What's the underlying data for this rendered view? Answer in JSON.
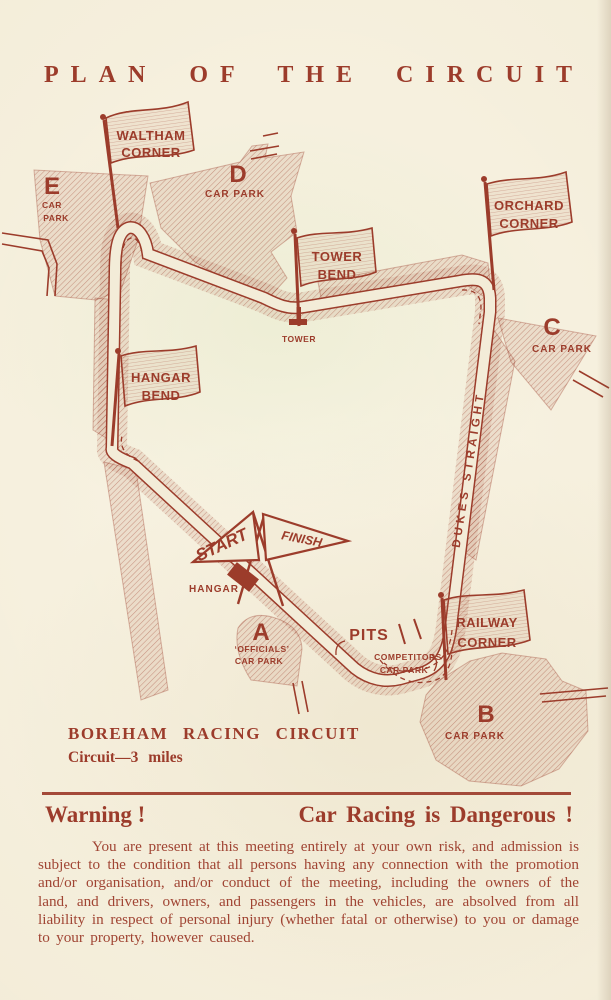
{
  "colors": {
    "ink": "#9c3c2b",
    "paper": "#f3ecd8",
    "hatch": "#b06a52"
  },
  "title": "PLAN OF THE CIRCUIT",
  "map": {
    "flags": {
      "waltham": {
        "line1": "WALTHAM",
        "line2": "CORNER"
      },
      "tower": {
        "line1": "TOWER",
        "line2": "BEND"
      },
      "orchard": {
        "line1": "ORCHARD",
        "line2": "CORNER"
      },
      "hangar": {
        "line1": "HANGAR",
        "line2": "BEND"
      },
      "railway": {
        "line1": "RAILWAY",
        "line2": "CORNER"
      }
    },
    "car_parks": {
      "e": {
        "letter": "E",
        "line1": "CAR",
        "line2": "PARK"
      },
      "d": {
        "letter": "D",
        "label": "CAR PARK"
      },
      "c": {
        "letter": "C",
        "label": "CAR PARK"
      },
      "b": {
        "letter": "B",
        "label": "CAR PARK"
      },
      "a": {
        "letter": "A",
        "line1": "‘OFFICIALS’",
        "line2": "CAR PARK"
      }
    },
    "labels": {
      "tower": "TOWER",
      "hangar": "HANGAR",
      "pits": "PITS",
      "competitors_line1": "COMPETITORS",
      "competitors_line2": "CAR PARK",
      "dukes": "DUKES STRAIGHT",
      "start": "START",
      "finish": "FINISH"
    }
  },
  "caption": {
    "line1": "BOREHAM RACING CIRCUIT",
    "line2": "Circuit—3 miles"
  },
  "warning": {
    "left": "Warning !",
    "right": "Car Racing is Dangerous !",
    "body": "You are present at this meeting entirely at your own risk, and admission is subject to the condition that all persons having any connection with the promotion and/or organisation, and/or conduct of the meeting, including the owners of the land, and drivers, owners, and passengers in the vehicles, are absolved from all liability in respect of personal injury (whether fatal or otherwise) to you or damage to your property, however caused."
  }
}
